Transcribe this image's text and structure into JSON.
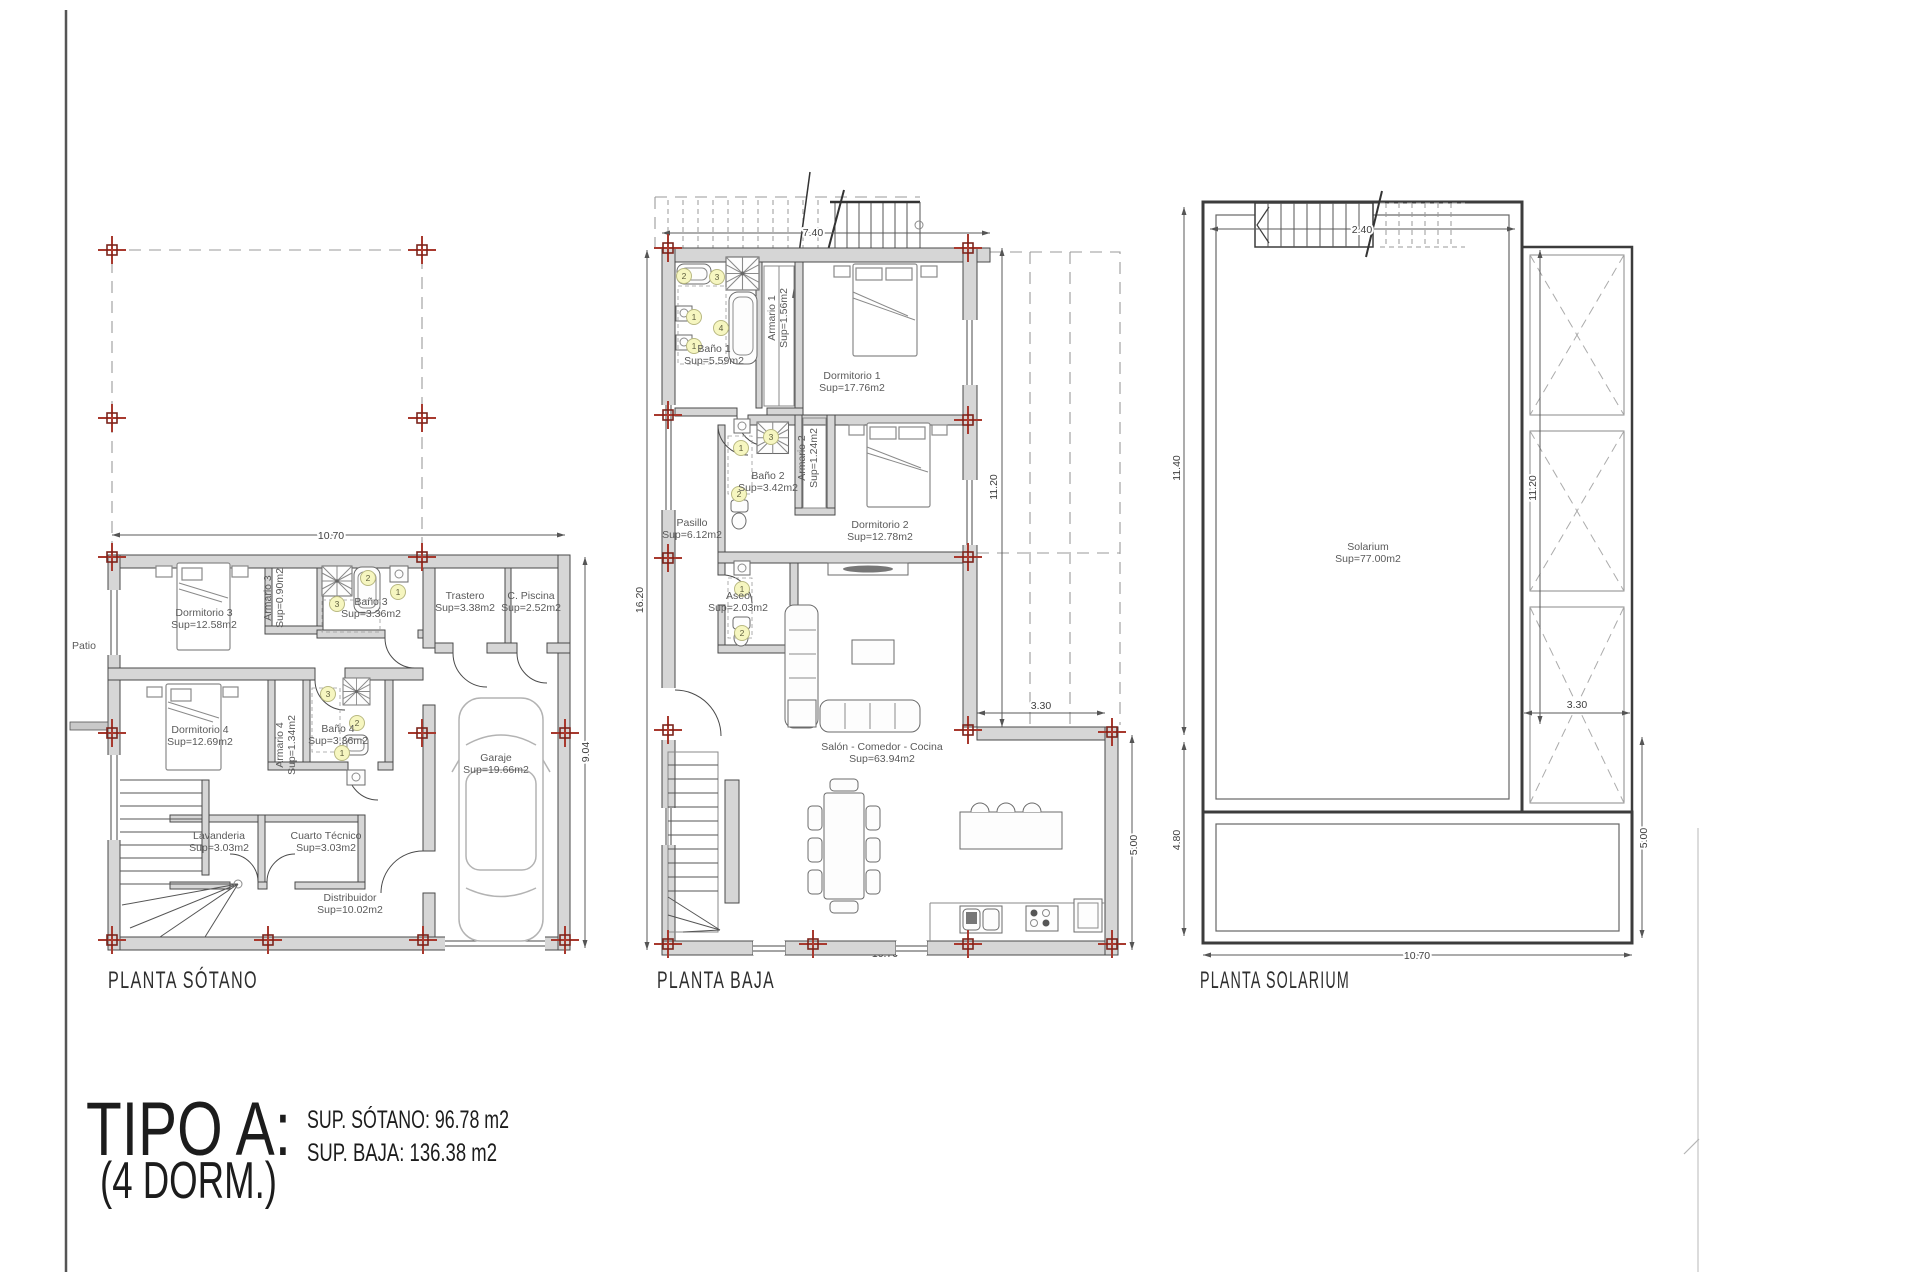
{
  "document": {
    "tipo_title": "TIPO A:",
    "tipo_subtitle": "(4 DORM.)",
    "sup_sotano": "SUP. SÓTANO: 96.78 m2",
    "sup_baja": "SU​P. BAJA: 136.38 m2"
  },
  "keys": {
    "k1": "1",
    "k2": "2",
    "k3": "3",
    "k4": "4"
  },
  "sotano": {
    "title": "PLANTA SÓTANO",
    "patio": "Patio",
    "dim_width": "10.70",
    "dim_height": "9.04",
    "rooms": {
      "dormitorio3": {
        "name": "Dormitorio 3",
        "area": "Sup=12.58m2"
      },
      "armario3": {
        "name": "Armario 3",
        "area": "Sup=0.90m2"
      },
      "bano3": {
        "name": "Baño 3",
        "area": "Sup=3.36m2"
      },
      "trastero": {
        "name": "Trastero",
        "area": "Sup=3.38m2"
      },
      "piscina": {
        "name": "C. Piscina",
        "area": "Sup=2.52m2"
      },
      "dormitorio4": {
        "name": "Dormitorio 4",
        "area": "Sup=12.69m2"
      },
      "armario4": {
        "name": "Armario 4",
        "area": "Sup=1.34m2"
      },
      "bano4": {
        "name": "Baño 4",
        "area": "Sup=3.36m2"
      },
      "lavanderia": {
        "name": "Lavanderia",
        "area": "Sup=3.03m2"
      },
      "cuarto_tecnico": {
        "name": "Cuarto Técnico",
        "area": "Sup=3.03m2"
      },
      "distribuidor": {
        "name": "Distribuidor",
        "area": "Sup=10.02m2"
      },
      "garaje": {
        "name": "Garaje",
        "area": "Sup=19.66m2"
      }
    }
  },
  "baja": {
    "title": "PLANTA BAJA",
    "dim_top": "7.40",
    "dim_left": "16.20",
    "dim_right": "11.20",
    "dim_inner": "3.30",
    "dim_right_low": "5.00",
    "dim_bottom": "10.70",
    "rooms": {
      "bano1": {
        "name": "Baño 1",
        "area": "Sup=5.59m2"
      },
      "armario1": {
        "name": "Armario 1",
        "area": "Sup=1.56m2"
      },
      "dormitorio1": {
        "name": "Dormitorio 1",
        "area": "Sup=17.76m2"
      },
      "bano2": {
        "name": "Baño 2",
        "area": "Sup=3.42m2"
      },
      "armario2": {
        "name": "Armario 2",
        "area": "Sup=1.24m2"
      },
      "dormitorio2": {
        "name": "Dormitorio 2",
        "area": "Sup=12.78m2"
      },
      "pasillo": {
        "name": "Pasillo",
        "area": "Sup=6.12m2"
      },
      "aseo": {
        "name": "Aseo",
        "area": "Sup=2.03m2"
      },
      "salon": {
        "name": "Salón - Comedor - Cocina",
        "area": "Sup=63.94m2"
      }
    }
  },
  "solarium": {
    "title": "PLANTA SOLARIUM",
    "dim_top": "2.40",
    "dim_left_up": "11.40",
    "dim_left_low": "4.80",
    "dim_right_in": "11.20",
    "dim_inner": "3.30",
    "dim_right_low": "5.00",
    "dim_bottom": "10.70",
    "rooms": {
      "solarium": {
        "name": "Solarium",
        "area": "Sup=77.00m2"
      }
    }
  }
}
